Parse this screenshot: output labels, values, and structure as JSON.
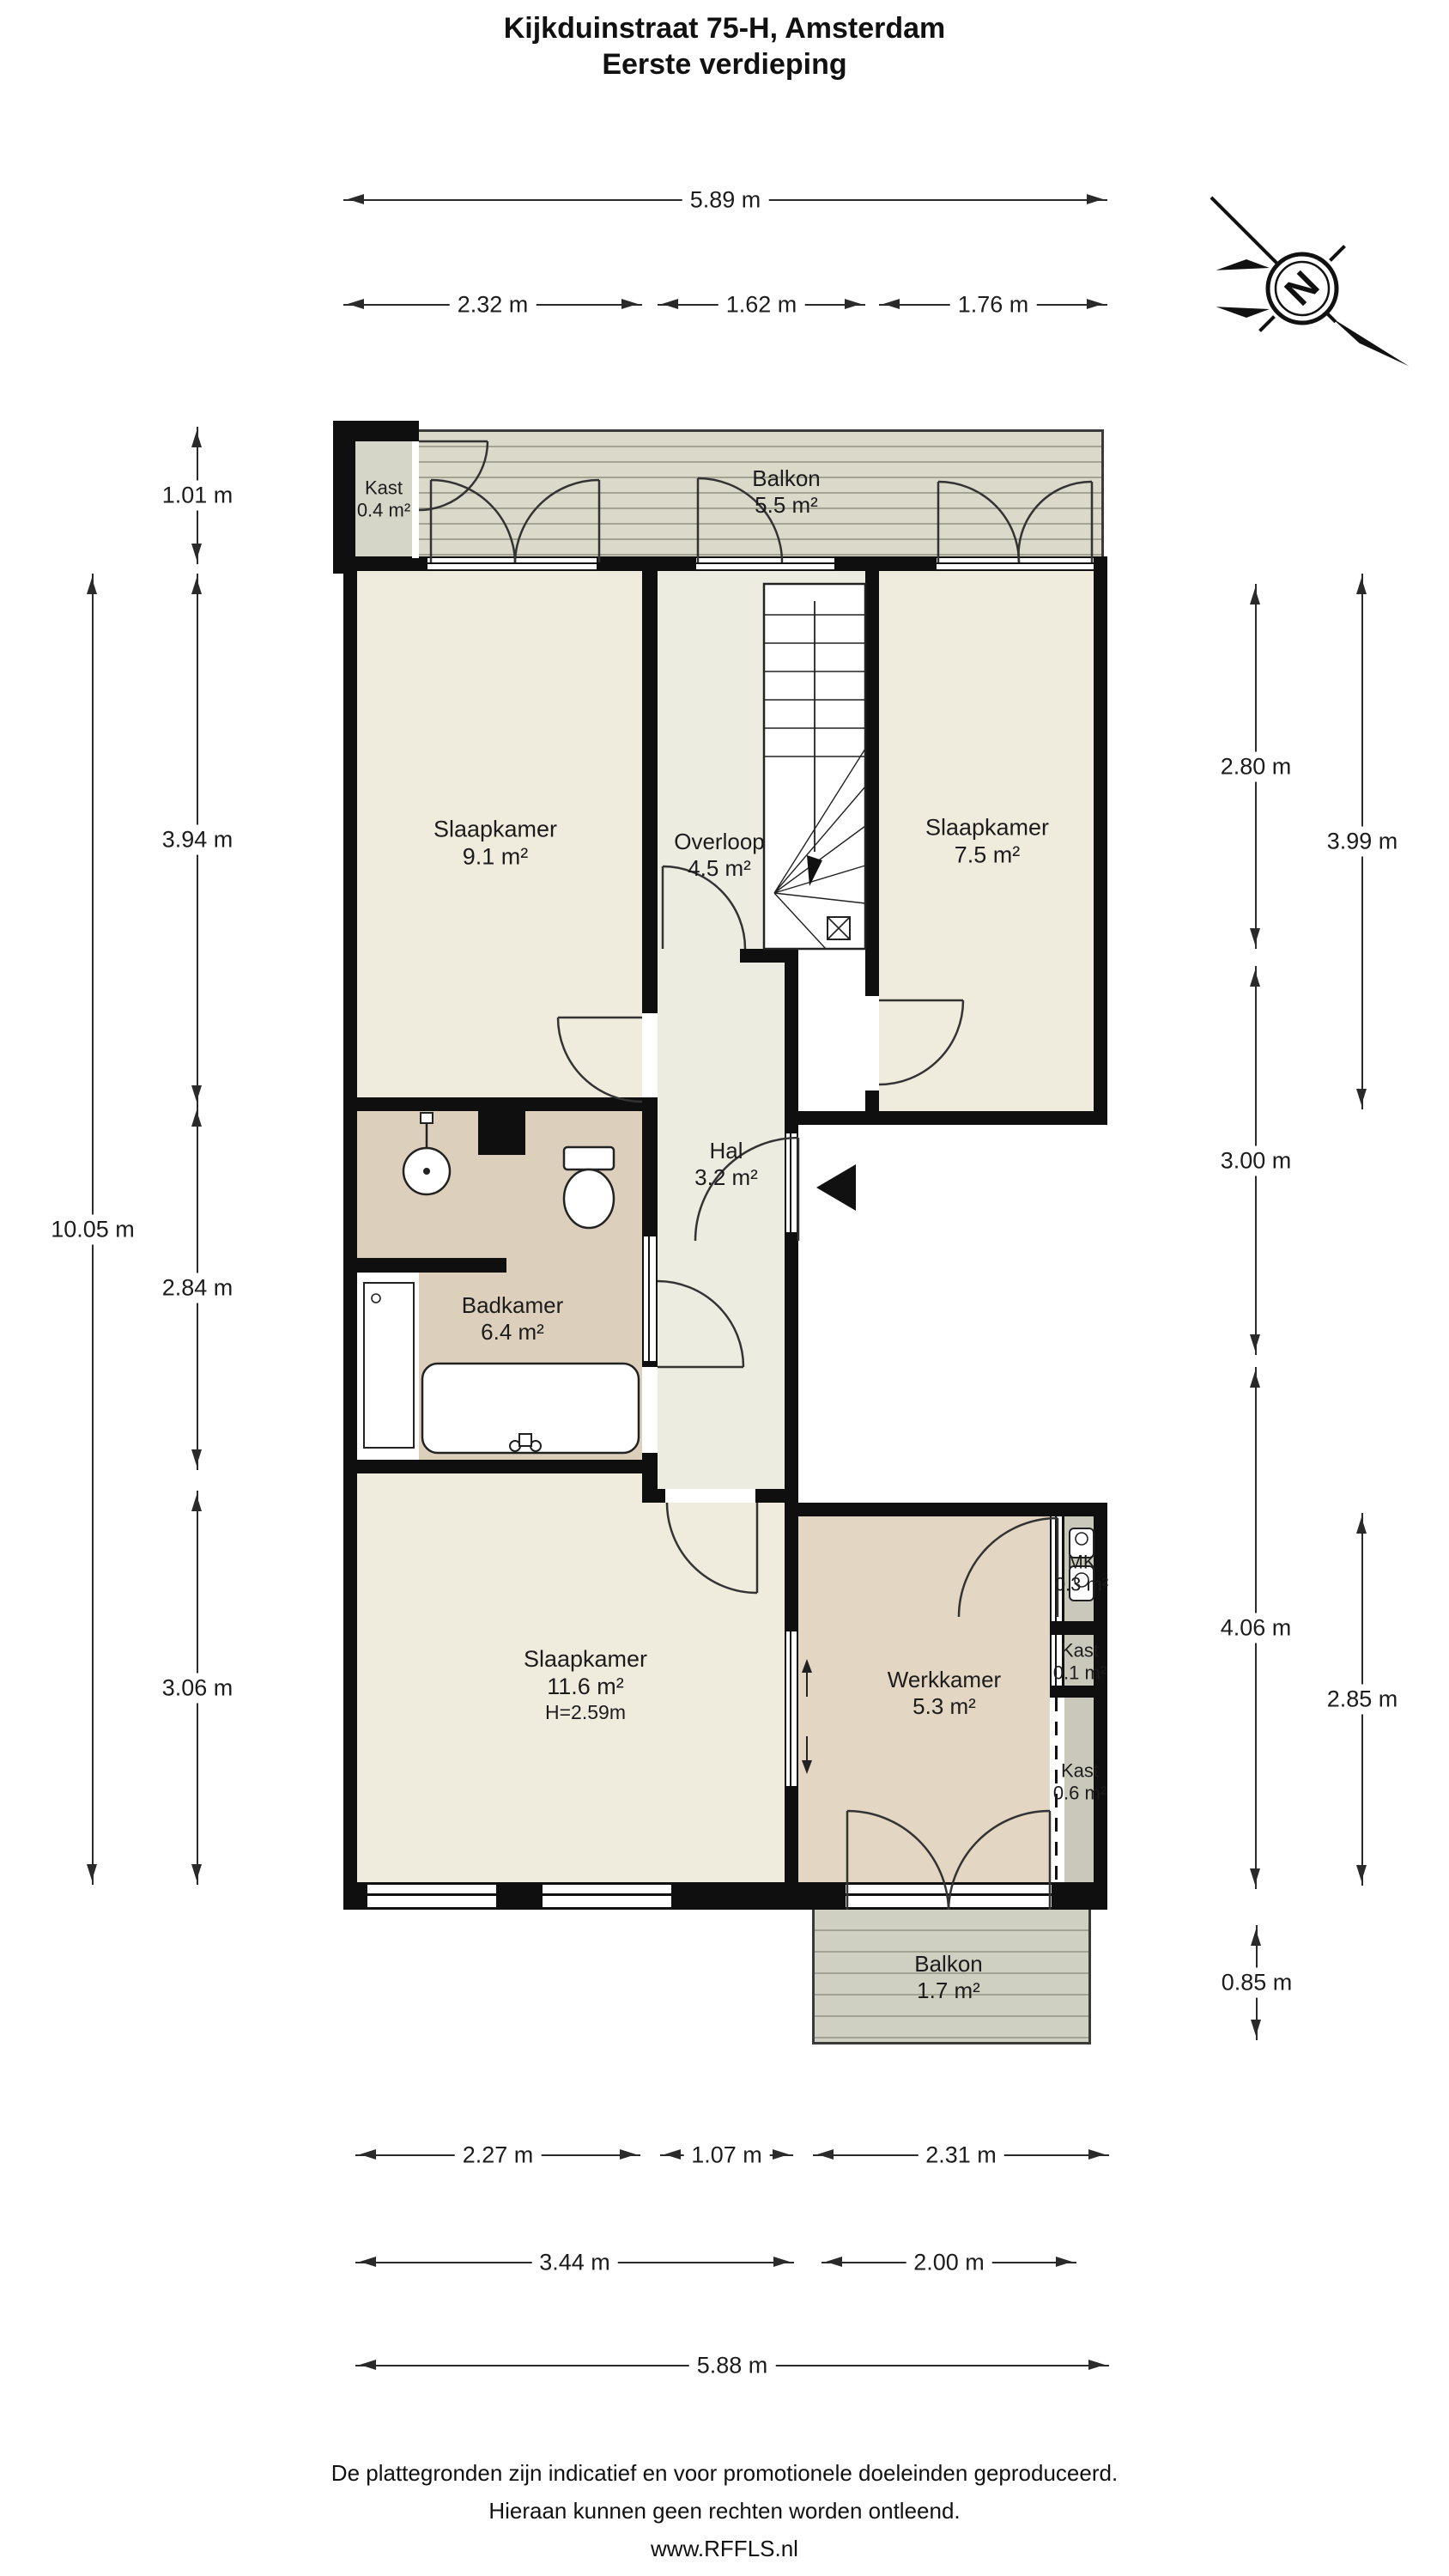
{
  "title": {
    "line1": "Kijkduinstraat 75-H, Amsterdam",
    "line2": "Eerste verdieping"
  },
  "compass": {
    "letter": "N"
  },
  "rooms": {
    "kast_top": {
      "name": "Kast",
      "area": "0.4 m²"
    },
    "balkon_top": {
      "name": "Balkon",
      "area": "5.5 m²"
    },
    "slaapkamer_1": {
      "name": "Slaapkamer",
      "area": "9.1 m²"
    },
    "overloop": {
      "name": "Overloop",
      "area": "4.5 m²"
    },
    "slaapkamer_2": {
      "name": "Slaapkamer",
      "area": "7.5 m²"
    },
    "hal": {
      "name": "Hal",
      "area": "3.2 m²"
    },
    "badkamer": {
      "name": "Badkamer",
      "area": "6.4 m²"
    },
    "slaapkamer_3": {
      "name": "Slaapkamer",
      "area": "11.6 m²",
      "ceiling_height": "H=2.59m"
    },
    "werkkamer": {
      "name": "Werkkamer",
      "area": "5.3 m²"
    },
    "mk": {
      "name": "MK",
      "area": "0.3 m²"
    },
    "kast_mid": {
      "name": "Kast",
      "area": "0.1 m²"
    },
    "kast_low": {
      "name": "Kast",
      "area": "0.6 m²"
    },
    "balkon_bottom": {
      "name": "Balkon",
      "area": "1.7 m²"
    }
  },
  "dimensions": {
    "top": [
      {
        "label": "5.89 m"
      },
      {
        "label": "2.32 m"
      },
      {
        "label": "1.62 m"
      },
      {
        "label": "1.76 m"
      }
    ],
    "left": [
      {
        "label": "1.01 m"
      },
      {
        "label": "3.94 m"
      },
      {
        "label": "10.05 m"
      },
      {
        "label": "2.84 m"
      },
      {
        "label": "3.06 m"
      }
    ],
    "right": [
      {
        "label": "2.80 m"
      },
      {
        "label": "3.00 m"
      },
      {
        "label": "4.06 m"
      },
      {
        "label": "3.99 m"
      },
      {
        "label": "2.85 m"
      },
      {
        "label": "0.85 m"
      }
    ],
    "bottom": [
      {
        "label": "2.27 m"
      },
      {
        "label": "1.07 m"
      },
      {
        "label": "2.31 m"
      },
      {
        "label": "3.44 m"
      },
      {
        "label": "2.00 m"
      },
      {
        "label": "5.88 m"
      }
    ]
  },
  "footer": {
    "line1": "De plattegronden zijn indicatief en voor promotionele doeleinden geproduceerd.",
    "line2": "Hieraan kunnen geen rechten worden ontleend.",
    "line3": "www.RFFLS.nl"
  },
  "colors": {
    "wall": "#0f0f0f",
    "room": "#f0ecdd",
    "hall": "#edece0",
    "bath": "#dcd0bc",
    "work": "#e3d6c2",
    "closet-top": "#d6d6c8",
    "closet": "#c9c9bb",
    "balcony-top": "#dbd9c9",
    "balcony-bottom": "#cfcfc2",
    "deck-line": "#a3a394",
    "line": "#2a2a2a",
    "text": "#1c1c1c"
  }
}
